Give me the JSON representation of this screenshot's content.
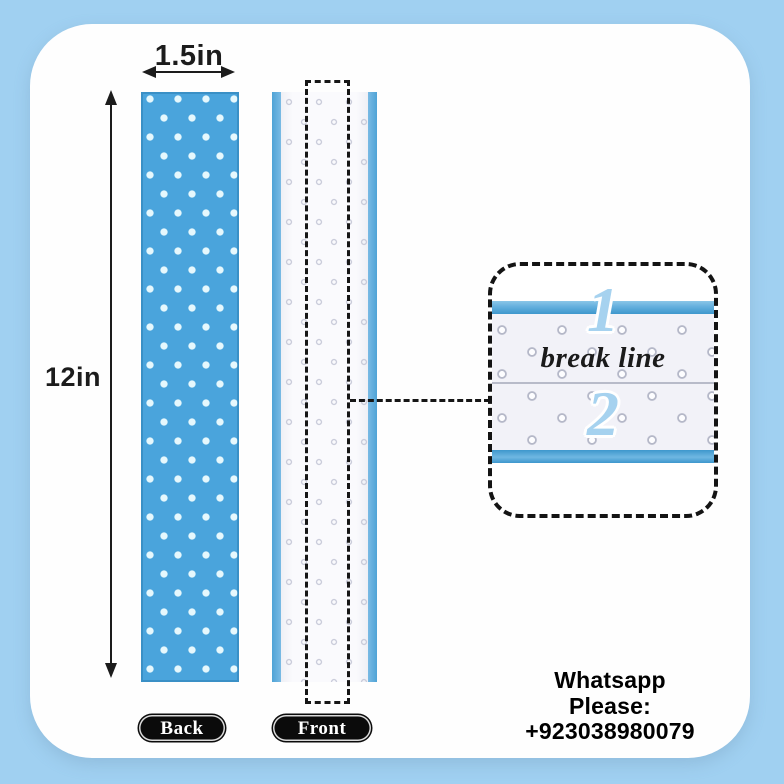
{
  "page": {
    "background_color": "#A0D0F1",
    "card_color": "#FEFEFE"
  },
  "dimensions": {
    "width_label": "1.5in",
    "height_label": "12in"
  },
  "strips": {
    "back": {
      "label": "Back",
      "color": "#4AA4DC",
      "dot_color": "#E6F8FD"
    },
    "front": {
      "label": "Front",
      "edge_color": "#4FA3D6",
      "surface_color": "#FAFAFD"
    }
  },
  "detail_callout": {
    "step1": "1",
    "caption": "break line",
    "step2": "2",
    "number_color": "#A6D2EF",
    "bar_color": "#3E97CD"
  },
  "contact": {
    "line1": "Whatsapp",
    "line2": "Please:",
    "line3": "+923038980079"
  }
}
